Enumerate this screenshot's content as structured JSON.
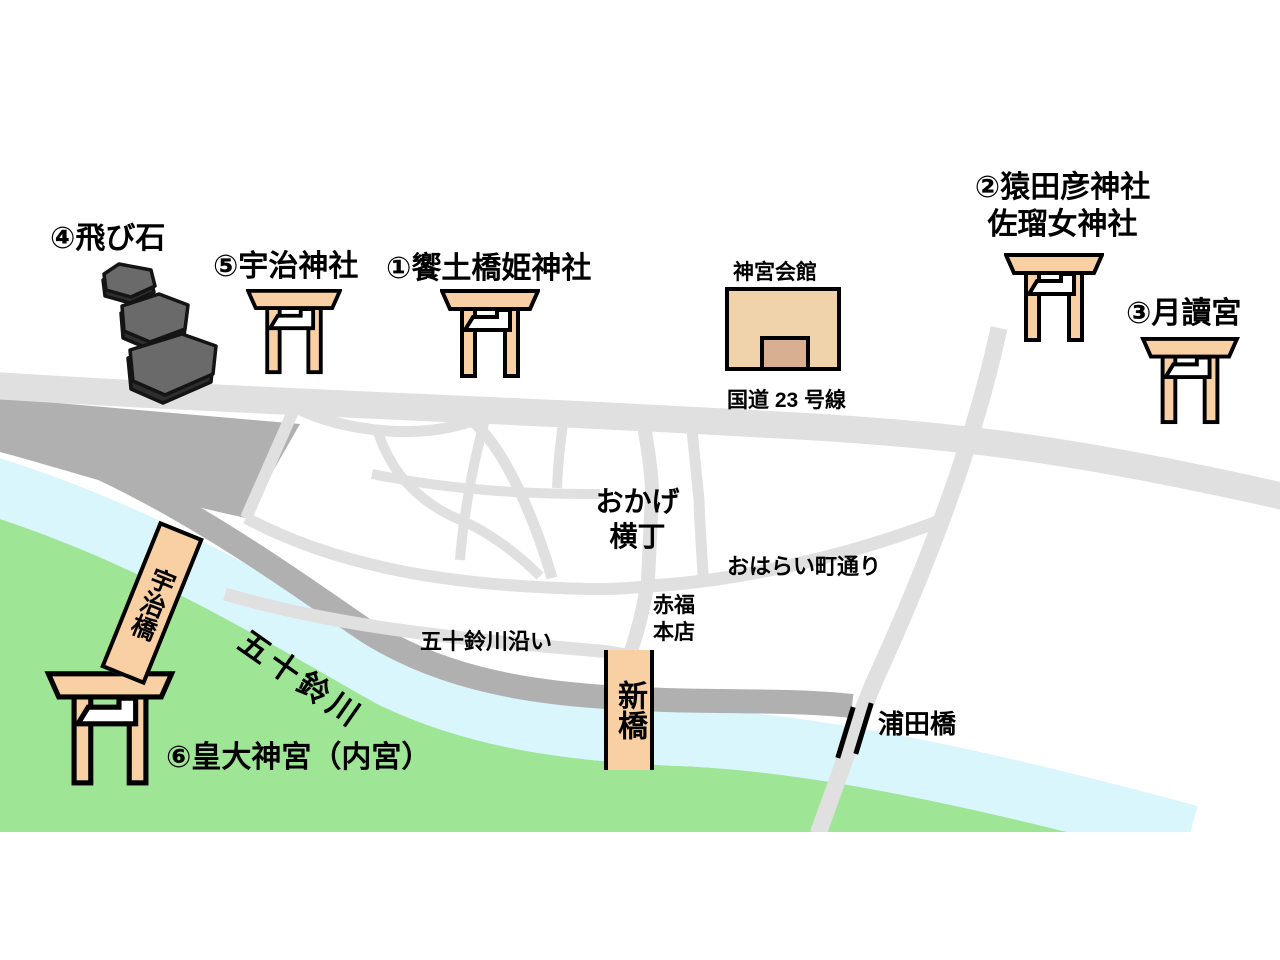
{
  "labels": {
    "tobiishi": "④飛び石",
    "uji_jinja": "⑤宇治神社",
    "aedo_hashihime": "①饗土橋姫神社",
    "jingu_kaikan": "神宮会館",
    "route23": "国道 23 号線",
    "sarutahiko": "②猿田彦神社",
    "sarume": "佐瑠女神社",
    "tsukiyomi": "③月讀宮",
    "okage_line1": "おかげ",
    "okage_line2": "横丁",
    "oharai": "おはらい町通り",
    "akafuku_line1": "赤福",
    "akafuku_line2": "本店",
    "isuzu_riverside": "五十鈴川沿い",
    "isuzu_river": "五十鈴川",
    "uji_bridge": "宇治橋",
    "shin_bridge": "新橋",
    "urata_bridge": "浦田橋",
    "kotai_jingu": "⑥皇大神宮（内宮）"
  },
  "colors": {
    "road_gray": "#e0e0e0",
    "land_shade_gray": "#b0b0b0",
    "river_blue": "#d9f6fd",
    "bank_green": "#9fe596",
    "torii_peach": "#f8d0a3",
    "building_fill": "#f0d2ab",
    "building_door": "#d8af90",
    "stone_gray": "#666666",
    "outline_black": "#000000"
  }
}
